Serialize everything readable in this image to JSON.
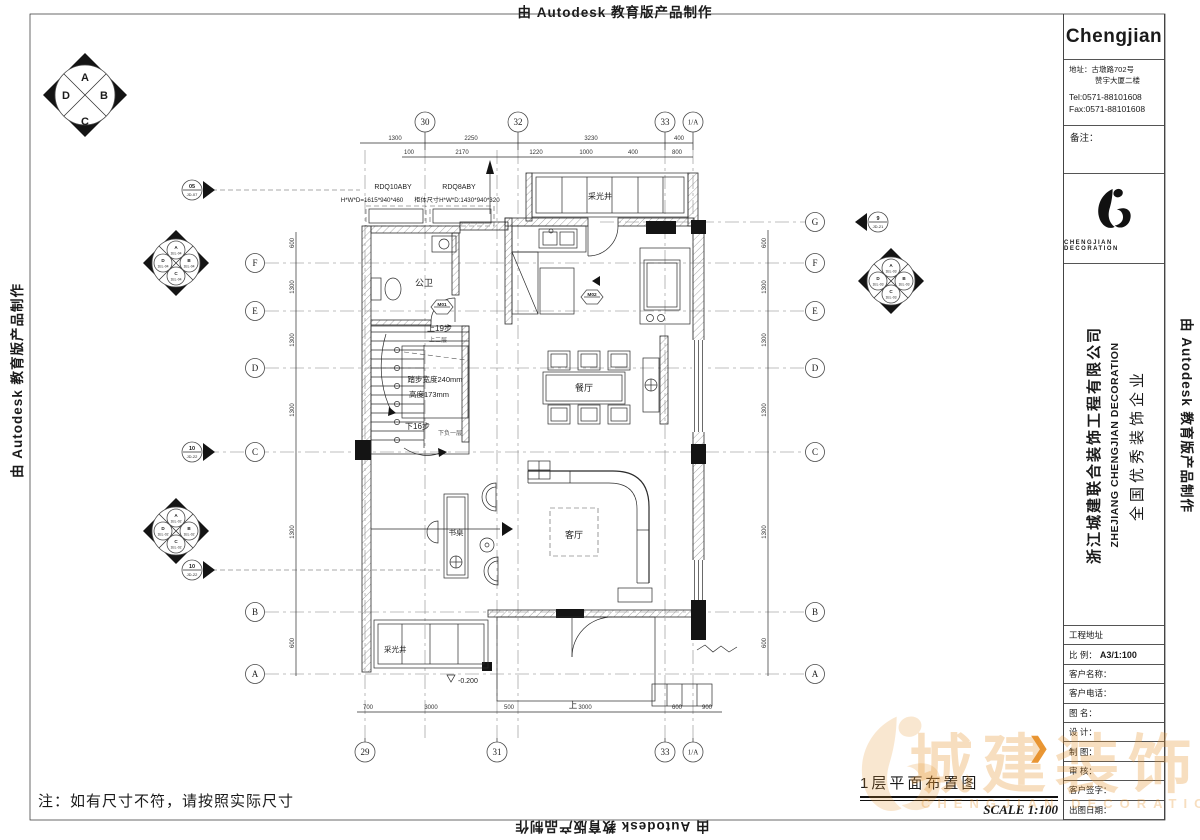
{
  "stamp": {
    "text": "由 Autodesk 教育版产品制作"
  },
  "titleblock": {
    "brand": "Chengjian",
    "address1": "地址：古墩路702号",
    "address2": "赞宇大厦二楼",
    "tel": "Tel:0571-88101608",
    "fax": "Fax:0571-88101608",
    "remark": "备注：",
    "logo_caption": "CHENGJIAN DECORATION",
    "company_cn": "浙江城建联合装饰工程有限公司",
    "company_en": "ZHEJIANG CHENGJIAN DECORATION",
    "slogan": "全国优秀装饰企业",
    "rows": [
      {
        "label": "工程地址",
        "value": ""
      },
      {
        "label": "比 例：",
        "value": "A3/1:100"
      },
      {
        "label": "客户名称：",
        "value": ""
      },
      {
        "label": "客户电话：",
        "value": ""
      },
      {
        "label": "图  名：",
        "value": ""
      },
      {
        "label": "设  计：",
        "value": ""
      },
      {
        "label": "制  图：",
        "value": ""
      },
      {
        "label": "审  核：",
        "value": ""
      },
      {
        "label": "客户签字：",
        "value": ""
      },
      {
        "label": "出图日期：",
        "value": ""
      }
    ]
  },
  "footer": {
    "note": "注：如有尺寸不符，请按照实际尺寸",
    "drawing_title": "1层平面布置图",
    "scale": "SCALE  1:100"
  },
  "brand_watermark": {
    "text": "城建装饰",
    "caption": "CHENGJIAN DECORATION",
    "arrow": "❯",
    "accent": "#e8912a"
  },
  "plan": {
    "rooms": {
      "bath": "公卫",
      "dining": "餐厅",
      "living": "客厅",
      "desk": "书桌",
      "skylight_top": "采光井",
      "skylight_bottom": "采光井"
    },
    "stair": {
      "up": "上19步",
      "up_to": "上二层",
      "tread": "踏步宽度240mm",
      "riser": "高度173mm",
      "down": "下16步",
      "down_to": "下负一层"
    },
    "cabinets": [
      {
        "model": "RDQ10ABY",
        "size": "H*W*D=1615*940*460"
      },
      {
        "model": "RDQ8ABY",
        "size": "柜体尺寸H*W*D:1430*940*320"
      }
    ],
    "doors": [
      "M01",
      "M02"
    ],
    "level": "-0.200",
    "entry_up": "上",
    "grid": {
      "top": [
        "30",
        "32",
        "33",
        "1/A"
      ],
      "bottom": [
        "29",
        "31",
        "33",
        "1/A"
      ],
      "left": [
        "F",
        "E",
        "D",
        "C",
        "B",
        "A"
      ],
      "right": [
        "G",
        "F",
        "E",
        "D",
        "C",
        "B",
        "A"
      ]
    },
    "dims": {
      "top1": [
        "1300",
        "2250",
        "3230",
        "400"
      ],
      "top2": [
        "100",
        "2170",
        "1220",
        "1000",
        "400",
        "800"
      ],
      "bottom": [
        "700",
        "3000",
        "500",
        "3000",
        "600",
        "900"
      ],
      "left": [
        "600",
        "1300",
        "1300",
        "1300",
        "1300",
        "600"
      ],
      "right": [
        "600",
        "1300",
        "1300",
        "1300",
        "1300",
        "600"
      ]
    },
    "sections": [
      {
        "num": "05",
        "code": "JD-07"
      },
      {
        "num": "10",
        "code": "JD-22"
      },
      {
        "num": "10",
        "code": "JD-22"
      },
      {
        "num": "9",
        "code": "JD-21"
      }
    ],
    "elev_main": {
      "a": "A",
      "b": "B",
      "c": "C",
      "d": "D"
    },
    "elev": [
      {
        "letters": [
          "A",
          "B",
          "C",
          "D"
        ],
        "code": "1EL-04"
      },
      {
        "letters": [
          "A",
          "B",
          "C",
          "D"
        ],
        "code": "1EL-02"
      },
      {
        "letters": [
          "A",
          "B",
          "C",
          "D"
        ],
        "code": "1EL-03"
      }
    ]
  }
}
